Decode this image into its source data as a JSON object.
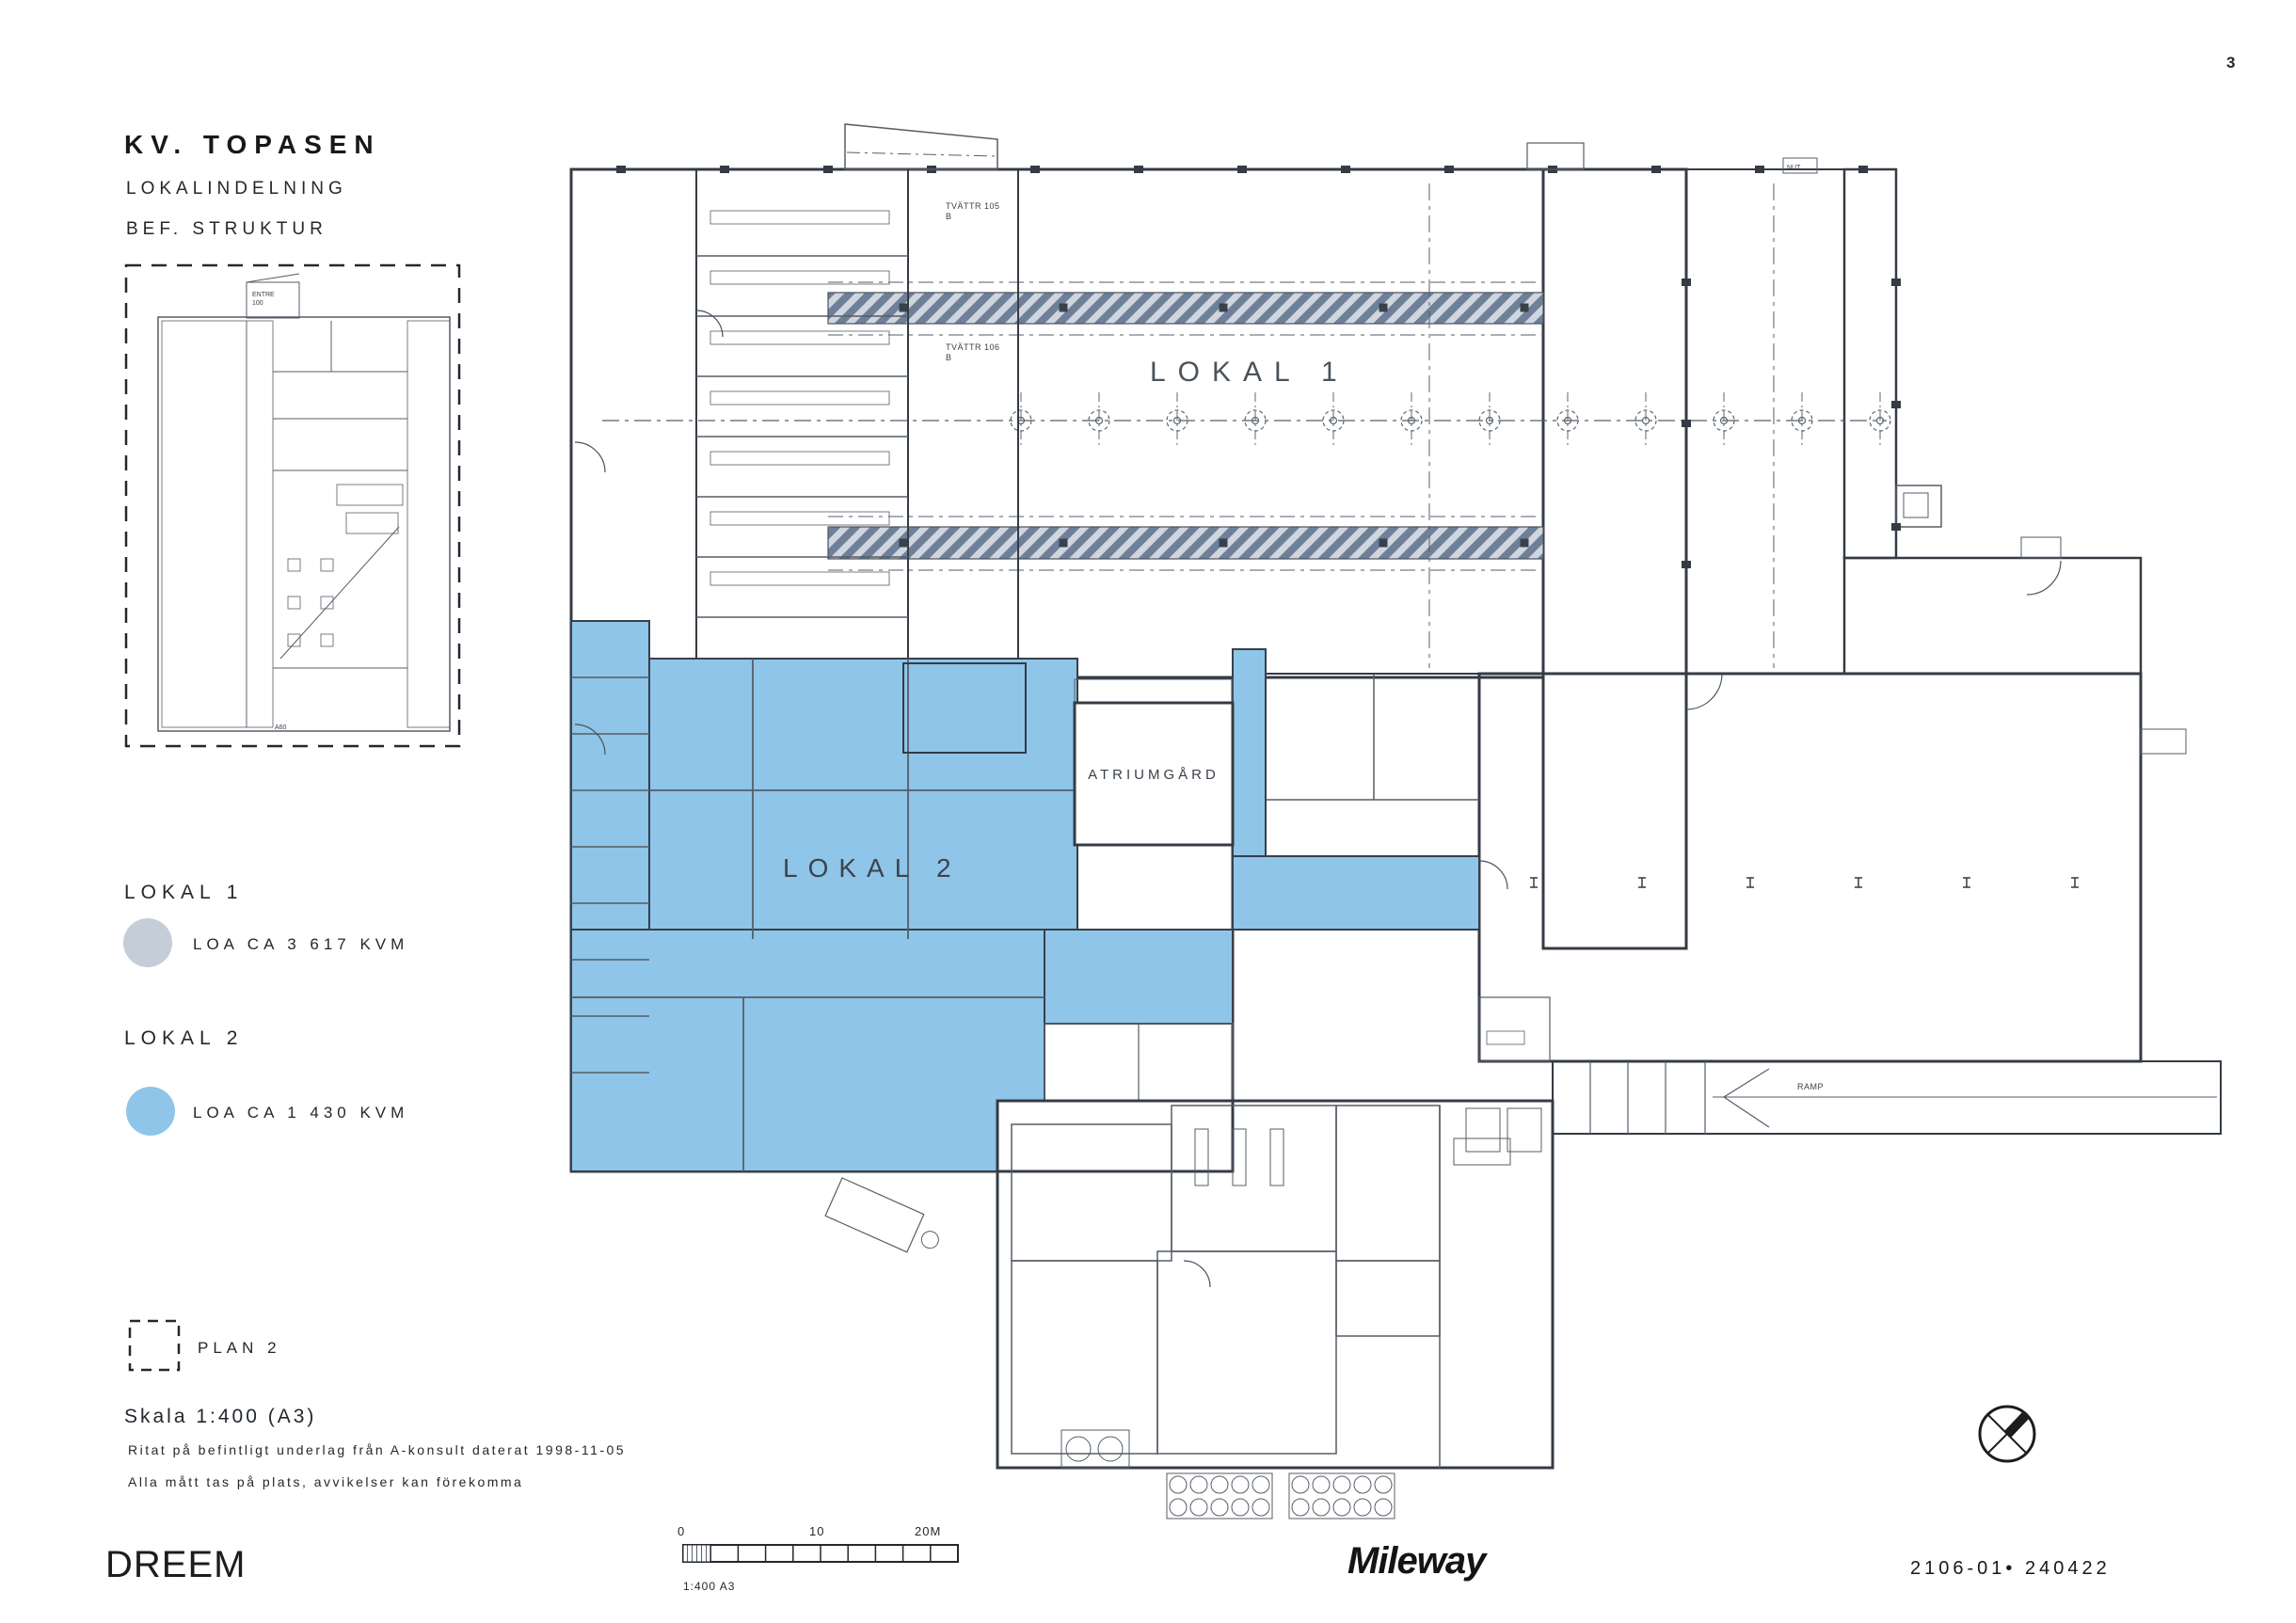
{
  "page": {
    "number": "3",
    "doc_ref": "2106-01• 240422"
  },
  "title_block": {
    "title": "KV. TOPASEN",
    "line1": "LOKALINDELNING",
    "line2": "BEF. STRUKTUR"
  },
  "legend": {
    "lokal1_label": "LOKAL 1",
    "lokal1_area": "LOA CA 3 617 KVM",
    "lokal2_label": "LOKAL 2",
    "lokal2_area": "LOA CA 1 430 KVM",
    "plan_label": "PLAN 2"
  },
  "notes": {
    "scale": "Skala 1:400 (A3)",
    "note1": "Ritat på befintligt underlag från A-konsult daterat 1998-11-05",
    "note2": "Alla mått tas på plats, avvikelser kan förekomma"
  },
  "footer": {
    "dreem": "DREEM",
    "mileway": "Mileway"
  },
  "scalebar": {
    "t0": "0",
    "t10": "10",
    "t20": "20M",
    "caption": "1:400 A3"
  },
  "plan_labels": {
    "lokal1": "LOKAL 1",
    "lokal2": "LOKAL 2",
    "atrium": "ATRIUMGÅRD",
    "ramp": "RAMP",
    "tvattr1": "TVÄTTR 105",
    "tvattr1b": "B",
    "tvattr2": "TVÄTTR 106",
    "tvattr2b": "B",
    "nut": "NUT",
    "entre": "ENTRE",
    "entre_no": "100",
    "a60": "A60"
  },
  "colors": {
    "lokal1": "#ccd3dc",
    "lokal2": "#8fc5e8",
    "legend_gray": "#c5cdd9",
    "legend_blue": "#8fc5e8",
    "wall": "#343b44",
    "band": "#6e8098"
  }
}
